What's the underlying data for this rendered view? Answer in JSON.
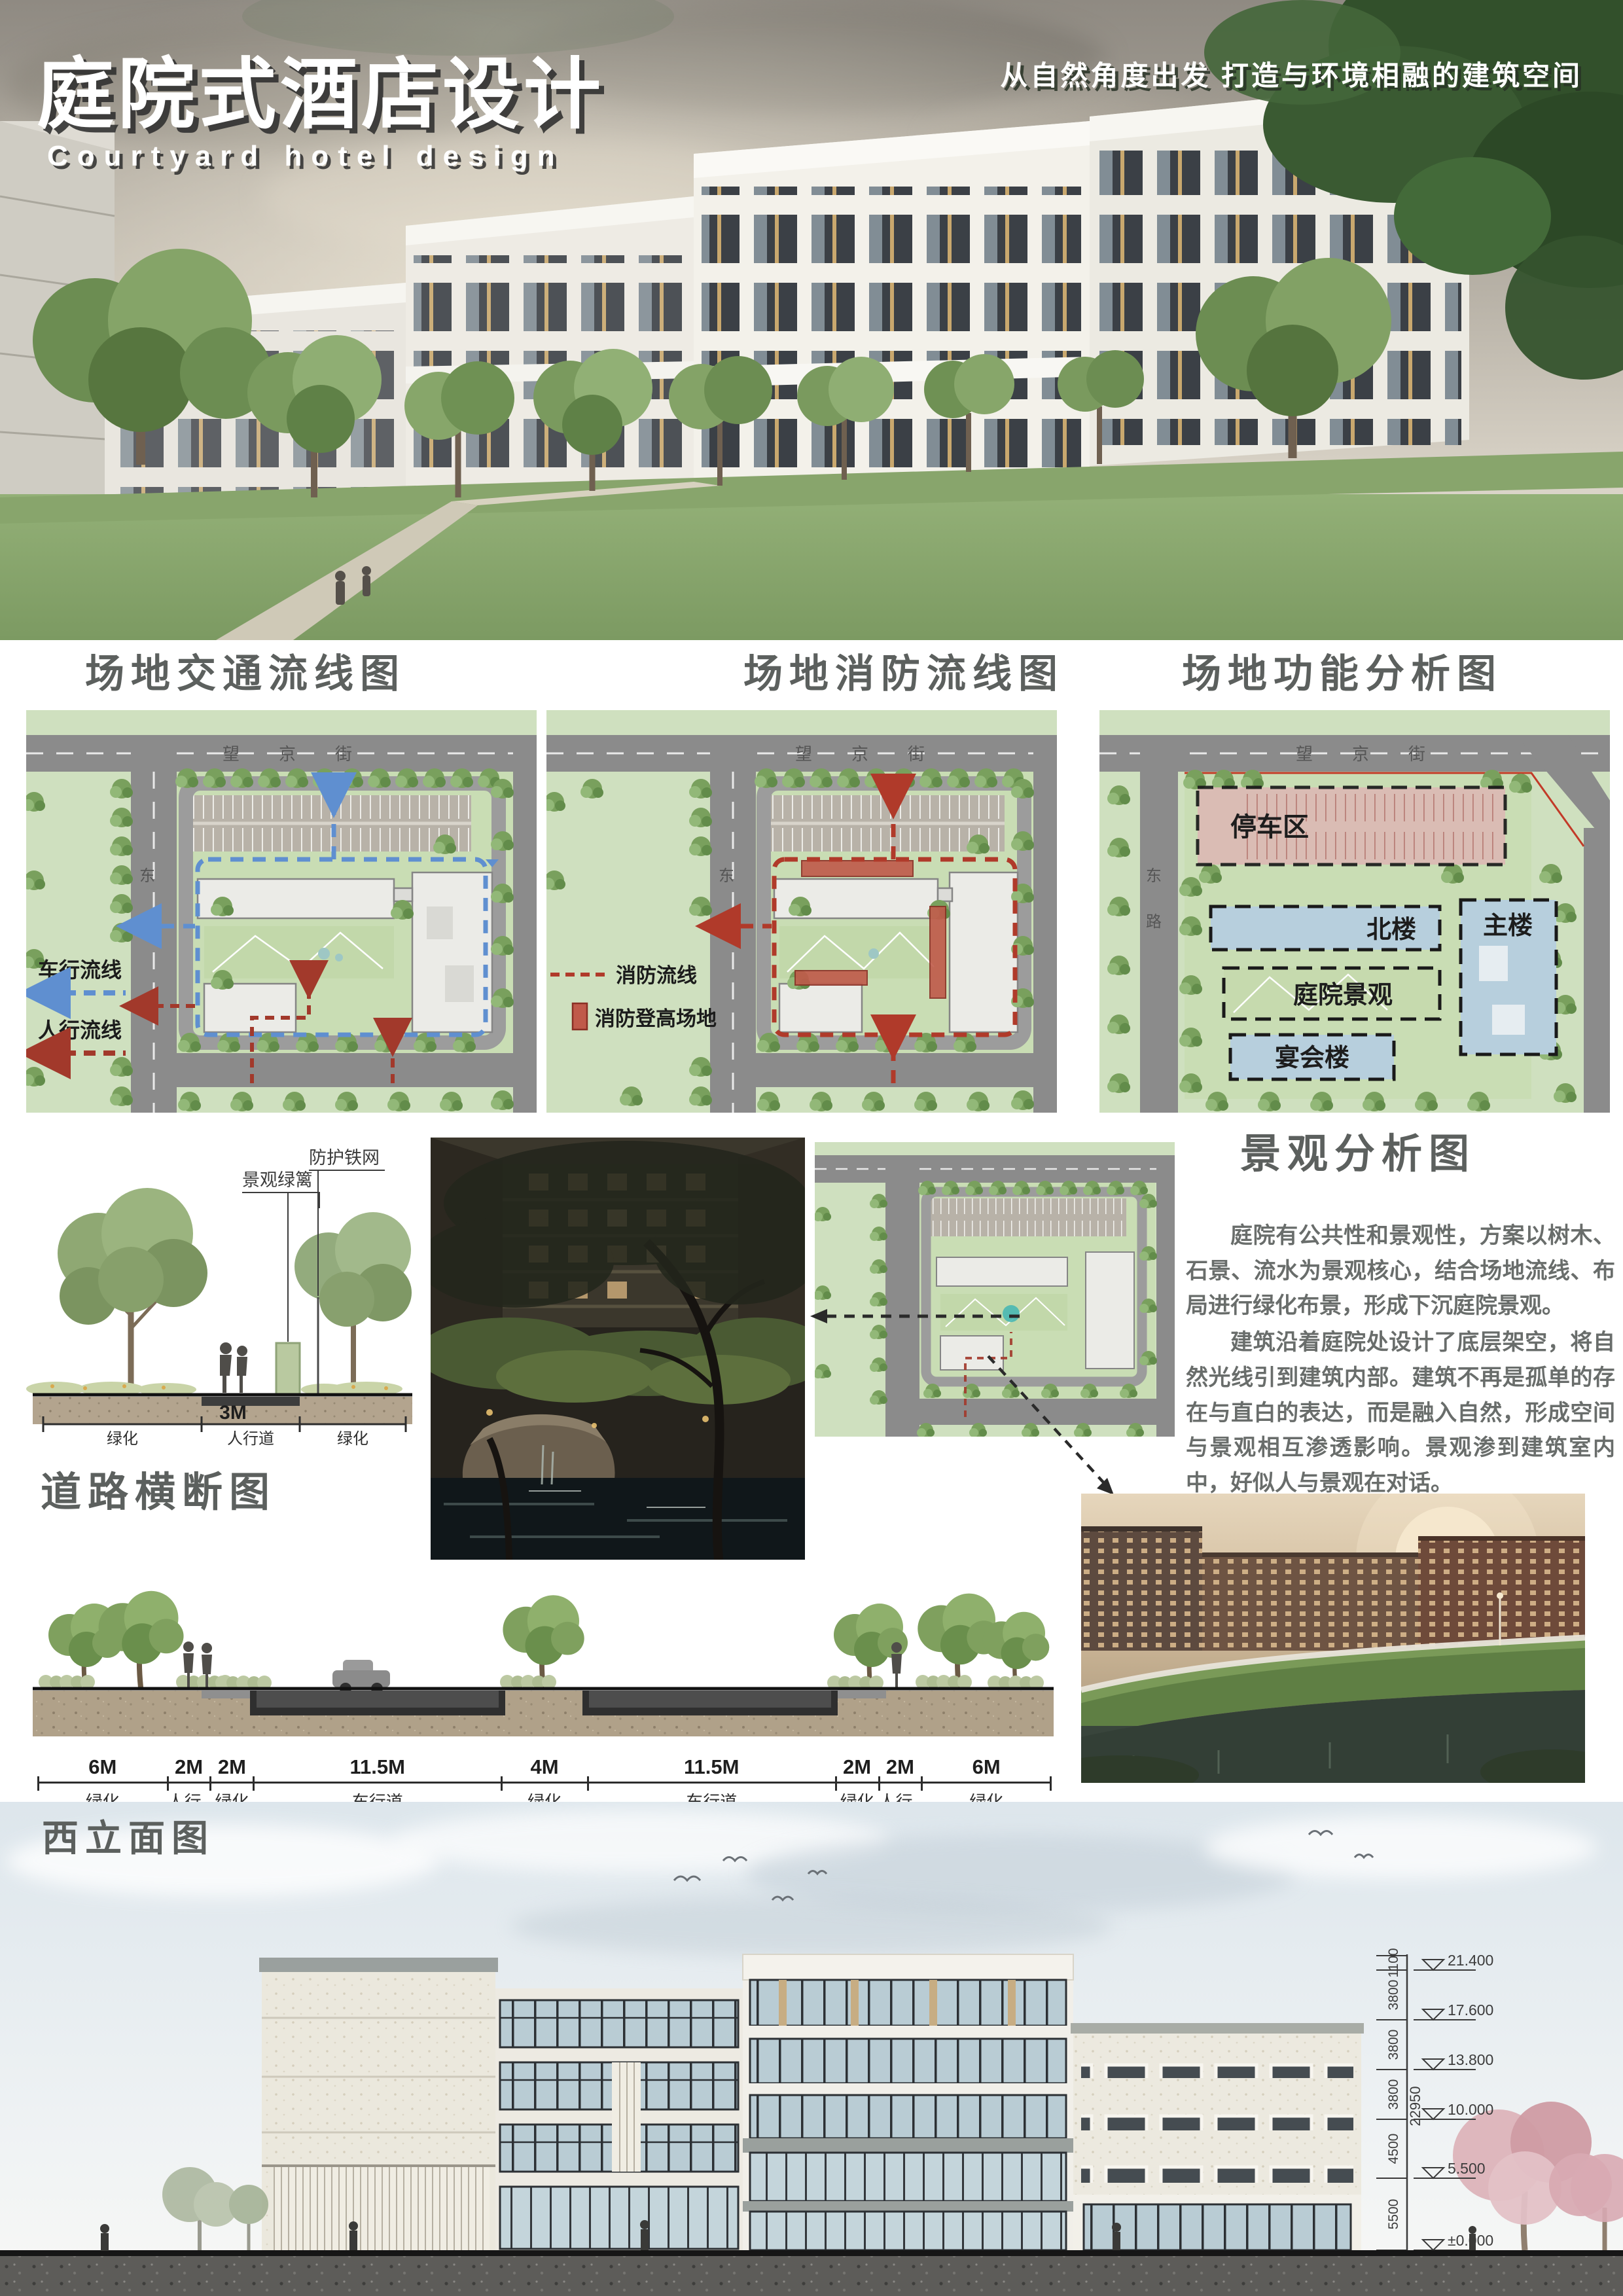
{
  "header": {
    "title_cn": "庭院式酒店设计",
    "title_en": "Courtyard hotel design",
    "slogan": "从自然角度出发 打造与环境相融的建筑空间"
  },
  "plans": {
    "road_top": "望京街",
    "road_side": "东路",
    "traffic": {
      "heading": "场地交通流线图",
      "legend_vehicle": "车行流线",
      "legend_pedestrian": "人行流线"
    },
    "fire": {
      "heading": "场地消防流线图",
      "legend_route": "消防流线",
      "legend_area": "消防登高场地"
    },
    "function": {
      "heading": "场地功能分析图",
      "zone_parking": "停车区",
      "zone_north": "北楼",
      "zone_main": "主楼",
      "zone_courtyard": "庭院景观",
      "zone_banquet": "宴会楼"
    }
  },
  "landscape": {
    "heading": "景观分析图",
    "para1": "庭院有公共性和景观性，方案以树木、石景、流水为景观核心，结合场地流线、布局进行绿化布景，形成下沉庭院景观。",
    "para2": "建筑沿着庭院处设计了底层架空，将自然光线引到建筑内部。建筑不再是孤单的存在与直白的表达，而是融入自然，形成空间与景观相互渗透影响。景观渗到建筑室内中，好似人与景观在对话。",
    "label_fence": "防护铁网",
    "label_hedge": "景观绿篱",
    "dim_3m": "3M",
    "dim_walk": "人行道",
    "dim_green_l": "绿化",
    "dim_green_r": "绿化"
  },
  "road_section": {
    "heading": "道路横断图",
    "dims": [
      {
        "m": "6M",
        "label": "绿化"
      },
      {
        "m": "2M",
        "label": "人行道"
      },
      {
        "m": "2M",
        "label": "绿化"
      },
      {
        "m": "11.5M",
        "label": "车行道"
      },
      {
        "m": "4M",
        "label": "绿化"
      },
      {
        "m": "11.5M",
        "label": "车行道"
      },
      {
        "m": "2M",
        "label": "绿化"
      },
      {
        "m": "2M",
        "label": "人行道"
      },
      {
        "m": "6M",
        "label": "绿化"
      }
    ]
  },
  "elevation": {
    "heading": "西立面图",
    "levels": [
      "21.400",
      "17.600",
      "13.800",
      "10.000",
      "5.500",
      "±0.000",
      "-0.450"
    ],
    "segs": [
      "1100",
      "3800",
      "3800",
      "3800",
      "4500",
      "5500",
      "450"
    ],
    "total": "22950"
  }
}
